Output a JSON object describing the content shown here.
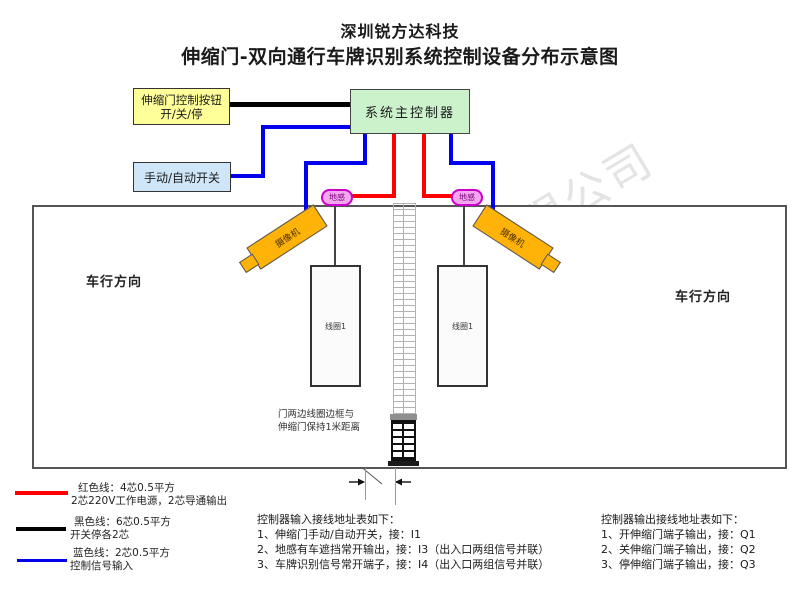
{
  "title": {
    "line1": "深圳锐方达科技",
    "line2": "伸缩门-双向通行车牌识别系统控制设备分布示意图"
  },
  "watermark": "深圳市锐方达科技有限公司",
  "controller_box": {
    "label": "系统主控制器"
  },
  "gate_button_box": {
    "line1": "伸缩门控制按钮",
    "line2": "开/关/停"
  },
  "manual_switch_box": {
    "label": "手动/自动开关"
  },
  "ground_sensor": {
    "left": "地感",
    "right": "地感"
  },
  "camera": {
    "left": "摄像机",
    "right": "摄像机"
  },
  "coil": {
    "left": "线圈1",
    "right": "线圈1"
  },
  "direction_label": {
    "left": "车行方向",
    "right": "车行方向"
  },
  "gate_note": {
    "line1": "门两边线圈边框与",
    "line2": "伸缩门保持1米距离"
  },
  "legend": {
    "red": {
      "title": "红色线：4芯0.5平方",
      "desc": "2芯220V工作电源，2芯导通输出"
    },
    "black": {
      "title": "黑色线：6芯0.5平方",
      "desc": "开关停各2芯"
    },
    "blue": {
      "title": "蓝色线：2芯0.5平方",
      "desc": "控制信号输入"
    }
  },
  "input_table": {
    "title": "控制器输入接线地址表如下：",
    "rows": [
      "1、伸缩门手动/自动开关，接：I1",
      "2、地感有车遮挡常开输出，接：I3（出入口两组信号并联）",
      "3、车牌识别信号常开端子，接：I4（出入口两组信号并联）"
    ]
  },
  "output_table": {
    "title": "控制器输出接线地址表如下：",
    "rows": [
      "1、开伸缩门端子输出，接：Q1",
      "2、关伸缩门端子输出，接：Q2",
      "3、停伸缩门端子输出，接：Q3"
    ]
  },
  "colors": {
    "wire_red": "#ff0000",
    "wire_blue": "#0000ee",
    "wire_black": "#000000",
    "controller_fill": "#ccf2cc",
    "button_fill": "#ffff99",
    "switch_fill": "#cfe6f8",
    "sensor_fill": "#f4a6f0",
    "camera_fill": "#ffb308",
    "car_left_fill": "#f5f5a2",
    "car_right_fill": "#cfe9fa",
    "arrow_fill": "#f8a6ca"
  }
}
